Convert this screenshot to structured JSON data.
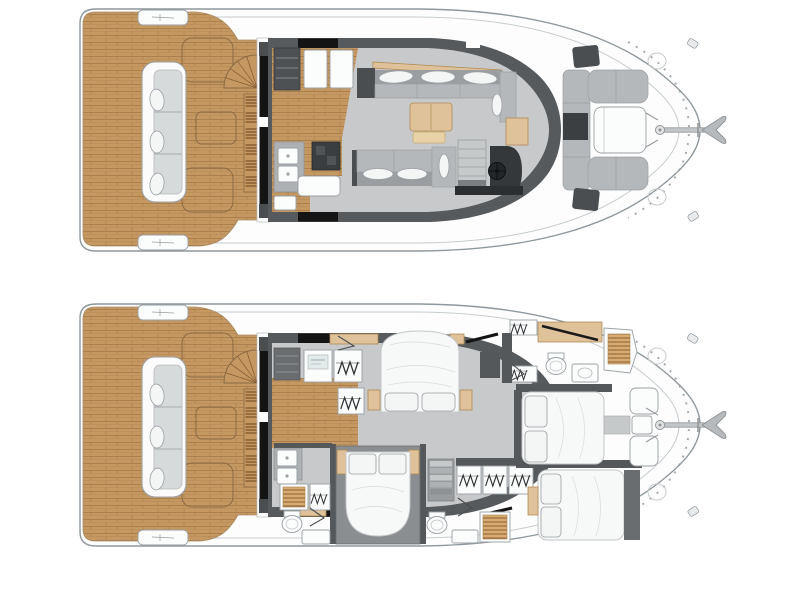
{
  "page": {
    "background": "#ffffff",
    "type": "yacht-deck-plan-diagram",
    "views": 2
  },
  "colors": {
    "page_bg": "#ffffff",
    "hull_fill": "#fdfdfd",
    "hull_stroke": "#8e979c",
    "hull_line": "#c6cccf",
    "teak": "#c59862",
    "teak_line": "#a87c49",
    "wall_dark": "#565a5d",
    "wall_mid": "#55585a",
    "black": "#141414",
    "floor_gray": "#c7c9ca",
    "furn_gray": "#b5b8ba",
    "furn_gray_dark": "#9b9ea1",
    "block_dark": "#4b4e50",
    "console_dark": "#35383a",
    "white_furn": "#fbfcfc",
    "furn_stroke": "#9aa0a4",
    "wood": "#dfc29a",
    "wood_stroke": "#b08c54",
    "bed_white": "#f7f8f8",
    "slat_bg": "#d8ab72",
    "slat_line": "#8a5f33",
    "appliance_dark": "#3b3e40",
    "room_mid_gray": "#8b8e90",
    "washer_panel": "#e3eaea"
  },
  "decks": [
    {
      "id": "main-deck",
      "position": "top",
      "areas": {
        "aft_cockpit": [
          "teak-deck",
          "c-shaped-sofa",
          "cockpit-table-outline",
          "storage-hatch-outlines",
          "flybridge-spiral-stairs",
          "slatted-steps",
          "sliding-glass-door",
          "boarding-pads"
        ],
        "galley": [
          "drawer-cabinet",
          "fridge-boxes",
          "double-sink",
          "stove",
          "aft-cabinets",
          "wood-floor"
        ],
        "salon": [
          "l-shaped-sofa",
          "three-pillows",
          "coffee-table",
          "bench",
          "facing-sofa",
          "two-pillows",
          "corner-seat"
        ],
        "helm": [
          "companionway-steps",
          "console",
          "steering-wheel",
          "chart-table",
          "side-table"
        ],
        "foredeck": [
          "u-shaped-lounge",
          "lounge-table",
          "sun-hatches",
          "deck-rings"
        ],
        "bow": [
          "anchor"
        ]
      }
    },
    {
      "id": "lower-deck",
      "position": "bottom",
      "areas": {
        "aft_cockpit": [
          "teak-deck",
          "c-shaped-sofa",
          "cockpit-table-outline",
          "storage-hatch-outlines",
          "flybridge-spiral-stairs",
          "slatted-steps",
          "sliding-glass-door",
          "boarding-pads"
        ],
        "utility_corridor": [
          "drawer-cabinet",
          "washing-machine",
          "wardrobe",
          "wardrobe",
          "double-sink",
          "wood-floor"
        ],
        "master_cabin": [
          "double-bed",
          "two-pillows",
          "nightstands",
          "wardrobes",
          "entry-door"
        ],
        "master_bathroom": [
          "closet",
          "toilet",
          "sink",
          "teak-shower",
          "door"
        ],
        "aft_cabin": [
          "double-bed",
          "two-pillows",
          "wood-trims"
        ],
        "aft_bathroom": [
          "teak-shower",
          "wardrobe",
          "toilet",
          "sink-counter",
          "doors"
        ],
        "midship": [
          "stairs-down",
          "wardrobe-row"
        ],
        "forward_cabins": [
          "starboard-bed",
          "port-bed",
          "pillows",
          "nightstand",
          "bathroom-toilet",
          "bathroom-shower"
        ],
        "bow": [
          "anchor",
          "storage-lockers",
          "step-pad",
          "deck-rings"
        ]
      }
    }
  ],
  "icons": {
    "anchor-icon": "anchor with shaft and flukes",
    "steering-wheel-icon": "helm wheel with spokes",
    "hanger-icon": "clothes hanger zigzag row",
    "toilet-icon": "toilet bowl ellipse",
    "sink-icon": "twin basin unit",
    "shower-icon": "teak slatted shower floor",
    "stairs-icon": "tread staircase",
    "spiral-stairs-icon": "fan shaped steps",
    "cleat-icon": "mooring cleat lines",
    "washer-icon": "washing machine front panel"
  }
}
